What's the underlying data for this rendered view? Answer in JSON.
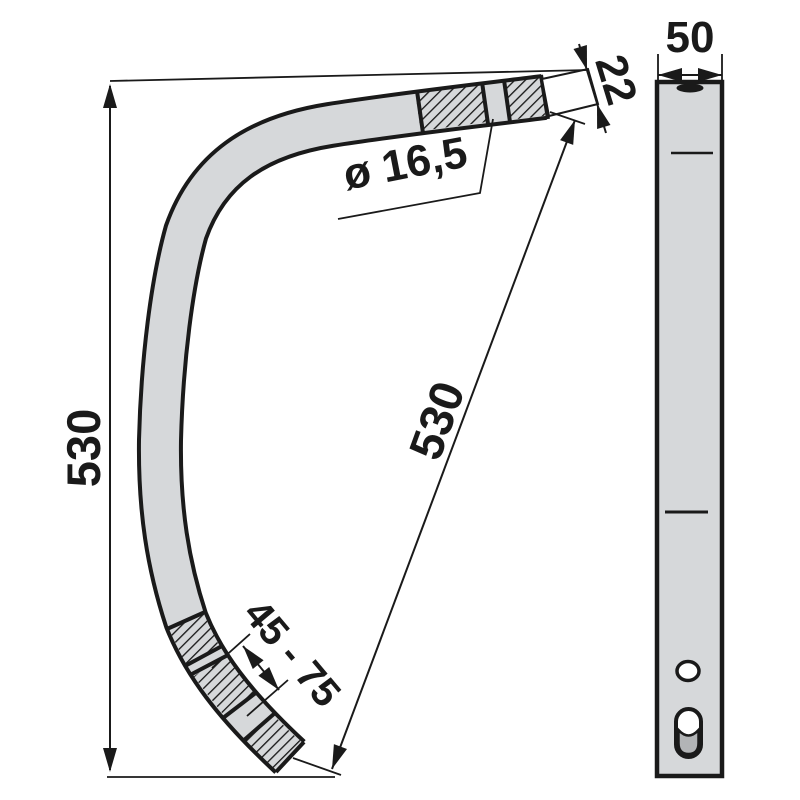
{
  "drawing": {
    "type": "technical-drawing-spring-tine",
    "labels": {
      "height": "530",
      "diagonal_length": "530",
      "tip_thickness": "22",
      "hole_diameter": "ø 16,5",
      "adjust_range": "45 - 75",
      "profile_width": "50"
    },
    "colors": {
      "line": "#1a1a1a",
      "part_fill": "#d6d8da",
      "slot_inner_fill": "#b2b4b6",
      "background": "#ffffff"
    }
  }
}
